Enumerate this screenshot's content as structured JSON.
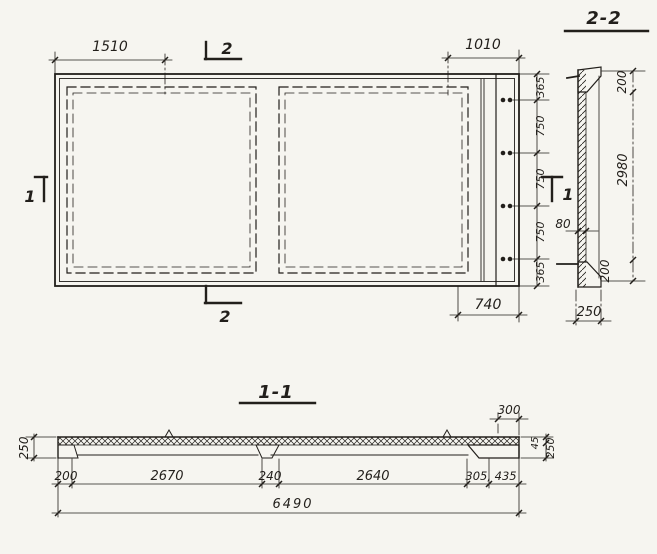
{
  "palette": {
    "paper": "#f6f5f0",
    "ink": "#221f1b"
  },
  "plan": {
    "dim_top_left": "1510",
    "dim_top_right": "1010",
    "dim_bottom_right": "740",
    "right_chain": [
      "365",
      "750",
      "750",
      "750",
      "365"
    ],
    "mark_1": "1",
    "mark_2": "2"
  },
  "section_2_2": {
    "title": "2-2",
    "dim_top": "200",
    "dim_height": "2980",
    "dim_web": "80",
    "dim_bottom": "200",
    "dim_width": "250"
  },
  "section_1_1": {
    "title": "1-1",
    "dim_left_height": "250",
    "dim_top_right": "300",
    "dim_chamfer": "45",
    "dim_right_height": "250",
    "chain": [
      "200",
      "2670",
      "240",
      "2640",
      "305, 435"
    ],
    "dim_total": "6490"
  }
}
